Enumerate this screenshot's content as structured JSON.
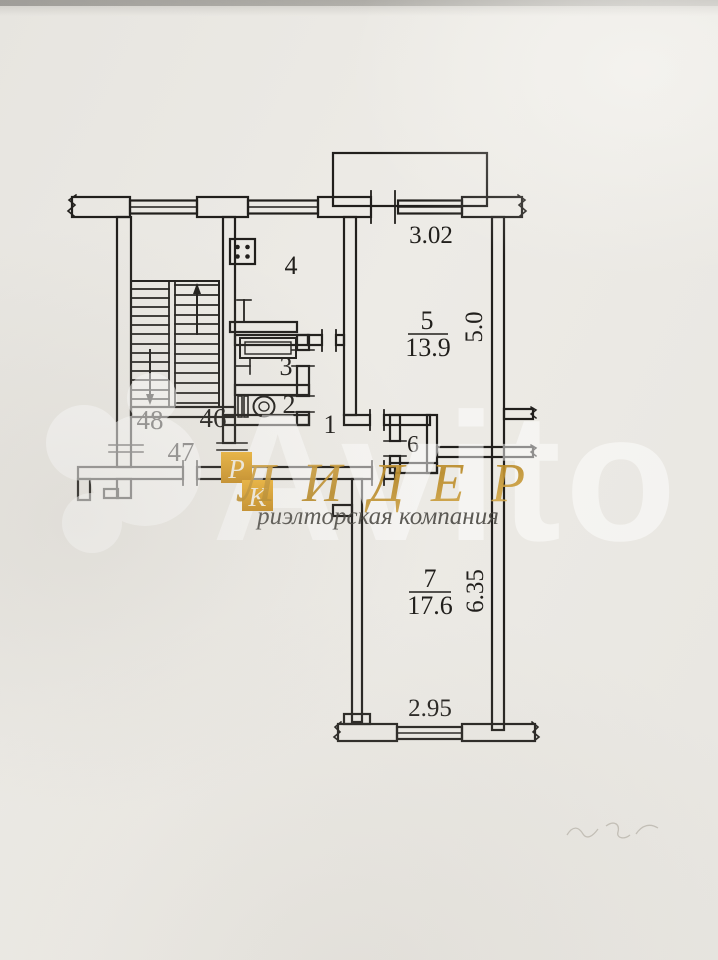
{
  "plan": {
    "room_labels": {
      "hallway": "1",
      "wc": "2",
      "bathroom": "3",
      "kitchen": "4",
      "living_room": "5",
      "closet": "6",
      "bedroom": "7"
    },
    "room_areas": {
      "living_room": "13.9",
      "bedroom": "17.6"
    },
    "dimensions": {
      "living_room_width": "3.02",
      "living_room_depth": "5.0",
      "bedroom_depth": "6.35",
      "bedroom_width": "2.95"
    },
    "stairwell_labels": {
      "left": "48",
      "right": "46",
      "landing": "47"
    }
  },
  "watermarks": {
    "agency_name": "ЛИДЕР",
    "agency_tagline": "риэлторская компания",
    "badge_letter_top": "Р",
    "badge_letter_bottom": "К",
    "marketplace": "Avito",
    "gold_color": "#cf9c30",
    "white_color": "#ffffff"
  },
  "colors": {
    "paper": "#eae8e3",
    "ink": "#211f1c"
  }
}
